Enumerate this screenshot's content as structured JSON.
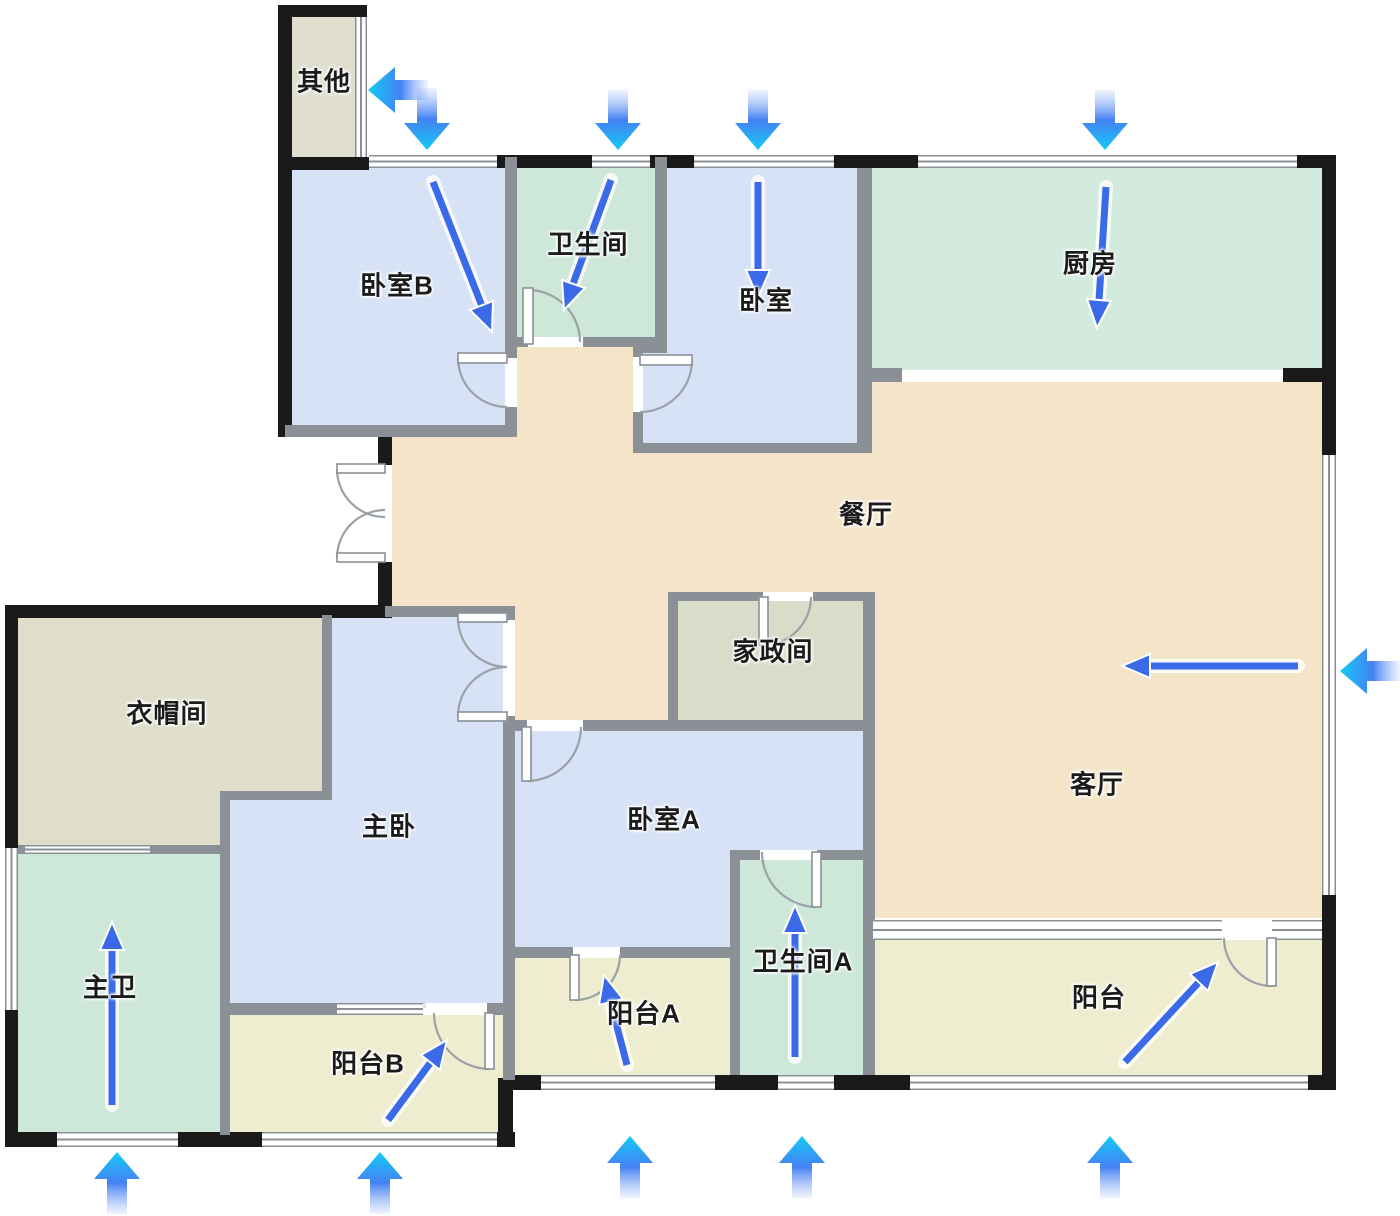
{
  "colors": {
    "wall_black": "#1a1a1a",
    "wall_gray": "#8b9096",
    "bedroom_fill": "#d7e2f7",
    "bath_fill": "#cde7d9",
    "kitchen_fill": "#d3eadf",
    "dining_fill": "#f4e5c9",
    "balcony_fill": "#efedcf",
    "cloak_fill": "#dfdeca",
    "housekeeping_fill": "#d9dcc9",
    "other_fill": "#dfdecf",
    "arrow_blue": "#3a6ae8",
    "arrow_cyan": "#14c9f4"
  },
  "floor_plan": {
    "rooms": [
      {
        "id": "other",
        "label": "其他"
      },
      {
        "id": "bedroom-b",
        "label": "卧室B"
      },
      {
        "id": "bathroom",
        "label": "卫生间"
      },
      {
        "id": "bedroom",
        "label": "卧室"
      },
      {
        "id": "kitchen",
        "label": "厨房"
      },
      {
        "id": "dining-room",
        "label": "餐厅"
      },
      {
        "id": "housekeeping-room",
        "label": "家政间"
      },
      {
        "id": "cloakroom",
        "label": "衣帽间"
      },
      {
        "id": "master-bedroom",
        "label": "主卧"
      },
      {
        "id": "bedroom-a",
        "label": "卧室A"
      },
      {
        "id": "master-bathroom",
        "label": "主卫"
      },
      {
        "id": "balcony-b",
        "label": "阳台B"
      },
      {
        "id": "balcony-a",
        "label": "阳台A"
      },
      {
        "id": "bathroom-a",
        "label": "卫生间A"
      },
      {
        "id": "living-room",
        "label": "客厅"
      },
      {
        "id": "balcony",
        "label": "阳台"
      }
    ],
    "airflow_arrows": {
      "exterior": [
        {
          "direction": "left",
          "location": "top-toward-other-room"
        },
        {
          "direction": "down",
          "location": "above-bedroom-b-window"
        },
        {
          "direction": "down",
          "location": "above-bathroom-window"
        },
        {
          "direction": "down",
          "location": "above-bedroom-window"
        },
        {
          "direction": "down",
          "location": "above-kitchen-window"
        },
        {
          "direction": "left",
          "location": "right-toward-living-room-window"
        },
        {
          "direction": "up",
          "location": "below-master-bathroom-window"
        },
        {
          "direction": "up",
          "location": "below-balcony-b-window"
        },
        {
          "direction": "up",
          "location": "below-balcony-a-window"
        },
        {
          "direction": "up",
          "location": "below-bathroom-a-window"
        },
        {
          "direction": "up",
          "location": "below-balcony-window"
        }
      ],
      "interior": [
        {
          "direction": "down-right",
          "room": "bedroom-b"
        },
        {
          "direction": "down-left",
          "room": "bathroom"
        },
        {
          "direction": "down",
          "room": "bedroom"
        },
        {
          "direction": "down",
          "room": "kitchen"
        },
        {
          "direction": "left",
          "room": "living-room"
        },
        {
          "direction": "up",
          "room": "master-bathroom"
        },
        {
          "direction": "up-right",
          "room": "balcony-b"
        },
        {
          "direction": "up",
          "room": "balcony-a"
        },
        {
          "direction": "up",
          "room": "bathroom-a"
        },
        {
          "direction": "up-right",
          "room": "balcony"
        }
      ]
    }
  }
}
